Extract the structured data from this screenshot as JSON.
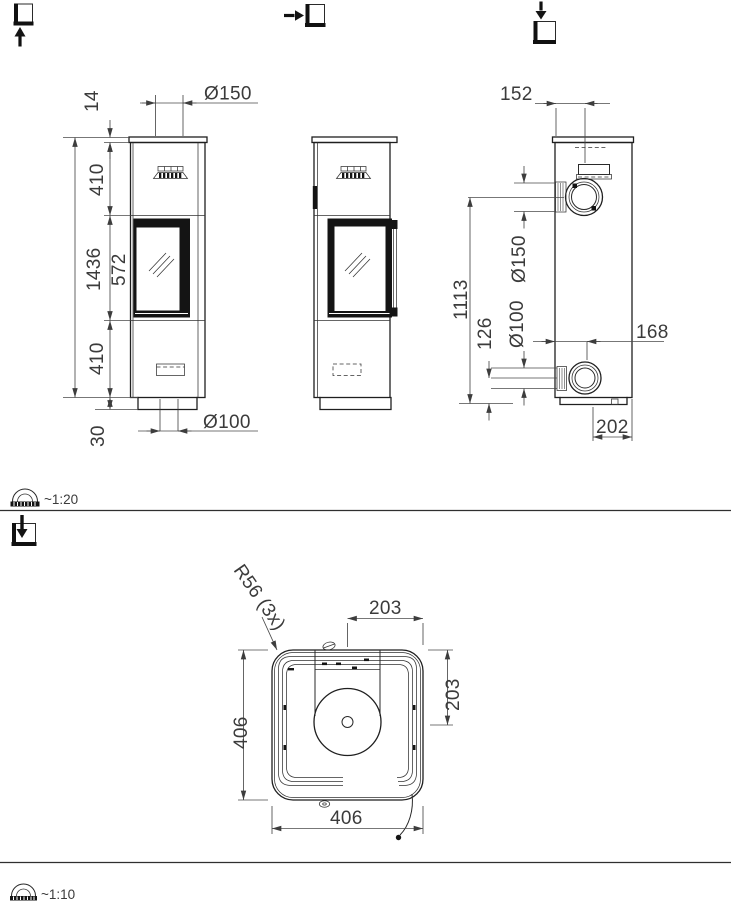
{
  "front_view": {
    "flue_diameter": "Ø150",
    "cap_thickness": "14",
    "upper_section": "410",
    "glass_section": "572",
    "lower_section": "410",
    "total_height": "1436",
    "plinth_height": "30",
    "bottom_inlet_diameter": "Ø100"
  },
  "rear_view": {
    "flue_offset": "152",
    "flue_center_height": "1113",
    "inlet_center_height": "126",
    "inlet_diameter": "Ø100",
    "flue_diameter": "Ø150",
    "inlet_offset": "168",
    "base_depth": "202"
  },
  "top_view": {
    "corner_radius": "R56 (3x)",
    "center_to_edge_width": "203",
    "center_to_edge_depth": "203",
    "overall_width": "406",
    "overall_depth": "406"
  },
  "scales": {
    "upper": "~1:20",
    "lower": "~1:10"
  },
  "icons": {
    "view_front": "view-from-front-icon",
    "view_side": "view-from-left-icon",
    "view_top": "view-from-top-icon",
    "scale": "protractor-scale-icon"
  }
}
